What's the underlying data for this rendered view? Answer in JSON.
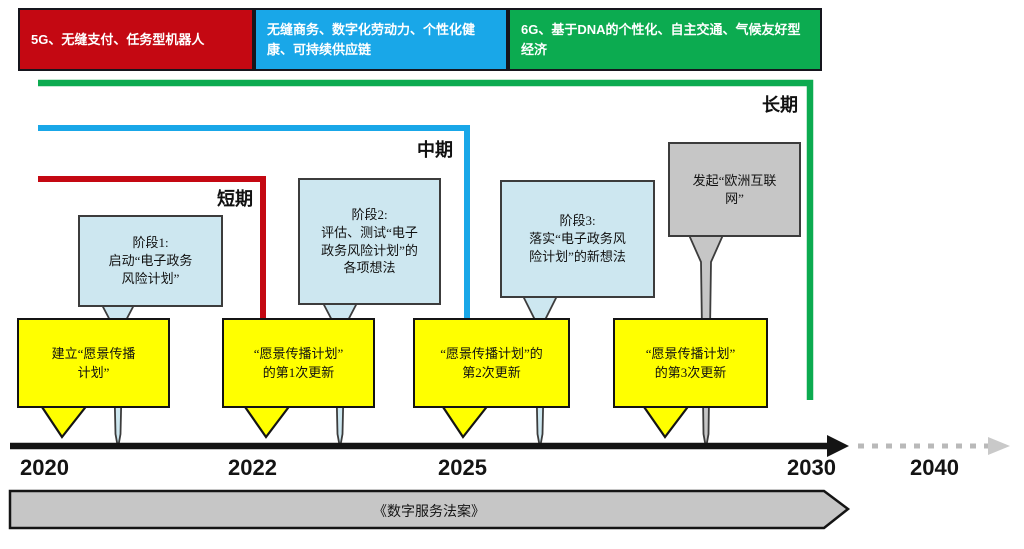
{
  "header_boxes": [
    {
      "label": "5G、无缝支付、任务型机器人",
      "color": "#c40812"
    },
    {
      "label": "无缝商务、数字化劳动力、个性化健康、可持续供应链",
      "color": "#19a7e8"
    },
    {
      "label": "6G、基于DNA的个性化、自主交通、气候友好型经济",
      "color": "#0cab50"
    }
  ],
  "period_labels": {
    "long": "长期",
    "mid": "中期",
    "short": "短期"
  },
  "phase_callouts": [
    {
      "text": "阶段1:\n启动“电子政务\n风险计划”"
    },
    {
      "text": "阶段2:\n评估、测试“电子\n政务风险计划”的\n各项想法"
    },
    {
      "text": "阶段3:\n落实“电子政务风\n险计划”的新想法"
    }
  ],
  "launch_callout": {
    "text": "发起“欧洲互联\n网”"
  },
  "milestones": [
    {
      "text": "建立“愿景传播\n计划”"
    },
    {
      "text": "“愿景传播计划”\n的第1次更新"
    },
    {
      "text": "“愿景传播计划”的\n第2次更新"
    },
    {
      "text": "“愿景传播计划”\n的第3次更新"
    }
  ],
  "timeline": {
    "years": [
      "2020",
      "2022",
      "2025",
      "2030",
      "2040"
    ]
  },
  "bottom_bar": {
    "label": "《数字服务法案》"
  },
  "colors": {
    "short_term_red": "#c40812",
    "mid_term_blue": "#19a7e8",
    "long_term_green": "#0cab50",
    "milestone_yellow": "#ffff00",
    "phase_fill": "#cde7f0",
    "gray_fill": "#c6c6c6",
    "axis_black": "#141414"
  }
}
